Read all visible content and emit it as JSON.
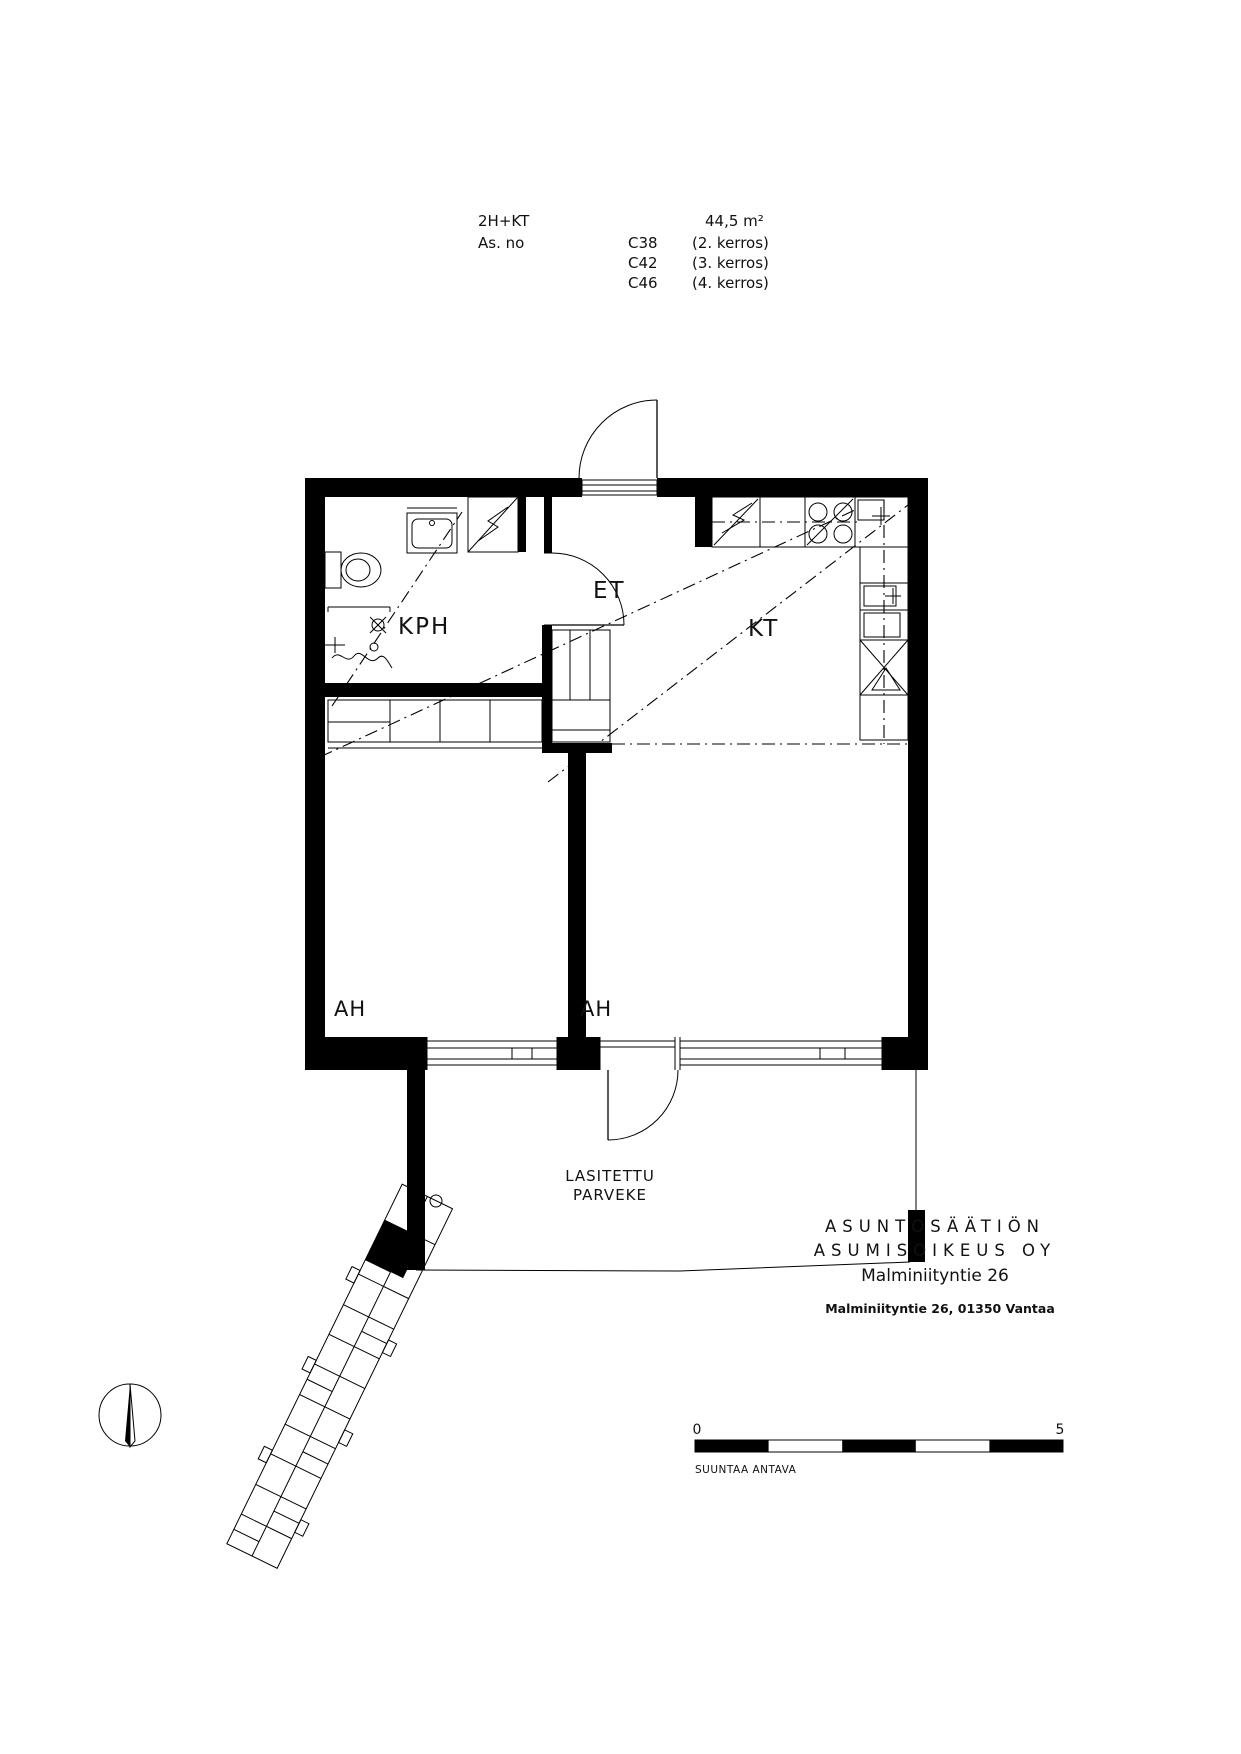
{
  "page": {
    "background": "#ffffff",
    "ink": "#000000"
  },
  "header": {
    "apartment_type": "2H+KT",
    "as_no_label": "As. no",
    "area": "44,5 m²",
    "units": [
      {
        "code": "C38",
        "floor": "(2. kerros)"
      },
      {
        "code": "C42",
        "floor": "(3. kerros)"
      },
      {
        "code": "C46",
        "floor": "(4. kerros)"
      }
    ]
  },
  "floorplan": {
    "rooms": {
      "bathroom": "KPH",
      "entry": "ET",
      "kitchen": "KT",
      "room_left": "AH",
      "room_right": "AH",
      "balcony_line1": "LASITETTU",
      "balcony_line2": "PARVEKE"
    }
  },
  "footer": {
    "company_line1": "ASUNTOSÄÄTIÖN",
    "company_line2": "ASUMISOIKEUS OY",
    "project": "Malminiityntie 26",
    "address": "Malminiityntie 26, 01350 Vantaa",
    "scale": {
      "start": "0",
      "end": "5",
      "note": "SUUNTAA ANTAVA"
    }
  }
}
